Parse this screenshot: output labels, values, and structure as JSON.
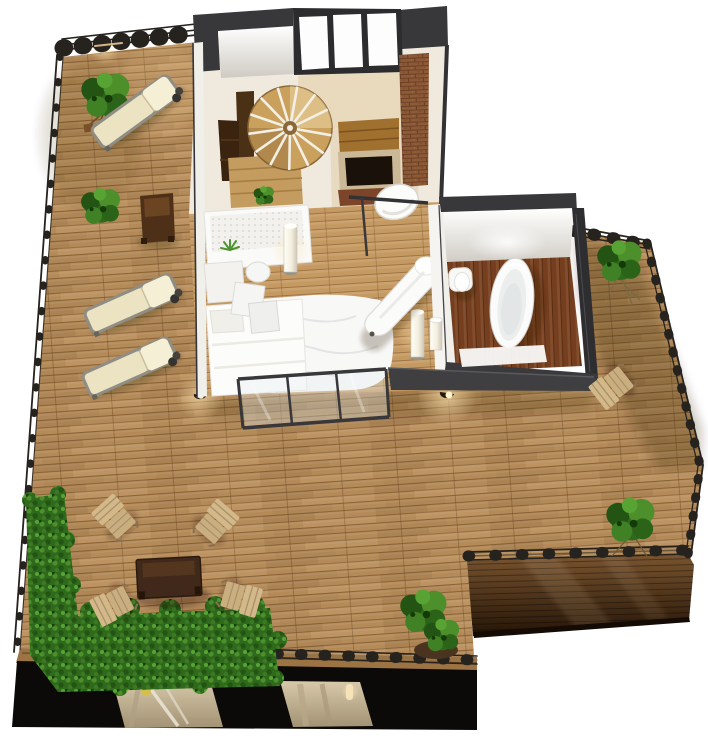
{
  "meta": {
    "title": "3D apartment floor plan with wrap-around wooden roof deck",
    "view": "top-down isometric architectural rendering",
    "background": "#ffffff"
  },
  "colors": {
    "background": "#ffffff",
    "deck_wood": "#b48a58",
    "deck_plank_line": "#8a6336",
    "deck_wood_light": "#c79a62",
    "deck_fascia": "#9c7444",
    "deck_side_top": "#7a5530",
    "deck_side_dark": "#241406",
    "bedroom_floor": "#c59a62",
    "bedroom_plank_line": "#9f7442",
    "bathroom_floor": "#753f1f",
    "bathroom_plank_line": "#572d14",
    "living_floor": "#efe9de",
    "wall_dark": "#38373a",
    "wall_white": "#f1efe9",
    "parapet": "#3f3e41",
    "brick": "#8d5a38",
    "brick_mortar": "#6b3f24",
    "facade_black": "#0c0a08",
    "facade_window": "#c9b99c",
    "soil": "#4a3420",
    "foliage": "#2f6a1c",
    "foliage_light": "#4c8f2b",
    "foliage_dark": "#245414",
    "railing": "#26221e",
    "cushion_cream": "#ece3c2",
    "cushion_back": "#f5efd6",
    "chair_wood": "#d3b88a",
    "table_wood": "#40291a",
    "bench_wood": "#4e3018",
    "stair_wood": "#c9a05c",
    "fixture_white": "#fbfbfb",
    "glow_warm": "#ffe3ae",
    "lamp_yellow": "#d4bf4e"
  },
  "rooms": [
    {
      "id": "living-room",
      "label": "Living room",
      "features": [
        "spiral staircase",
        "kitchen counter",
        "brick fireplace",
        "white armchair",
        "windows on north wall"
      ]
    },
    {
      "id": "bedroom",
      "label": "Bedroom / lounge",
      "features": [
        "white bed",
        "fluffy white rug",
        "white chaise longue",
        "desk with pegboard and aloe plant",
        "two cylinder floor lamps",
        "two cube stools",
        "glass window wall to deck"
      ]
    },
    {
      "id": "hallway",
      "label": "Hallway",
      "features": [
        "pedestal sink"
      ]
    },
    {
      "id": "bathroom",
      "label": "Bathroom",
      "features": [
        "freestanding oval bathtub",
        "toilet",
        "white bath mat",
        "dark plank floor",
        "ceiling light"
      ]
    }
  ],
  "outdoor": {
    "areas": [
      {
        "id": "upper-terrace",
        "label": "Upper left terrace"
      },
      {
        "id": "main-roof-deck",
        "label": "Main roof deck"
      },
      {
        "id": "side-terrace",
        "label": "Right side terrace"
      }
    ],
    "furniture": [
      {
        "type": "sun lounger with wheels",
        "count": 3
      },
      {
        "type": "wooden folding chair",
        "count": 5
      },
      {
        "type": "dark coffee table",
        "count": 1
      },
      {
        "type": "dark side bench",
        "count": 1
      }
    ],
    "plants": [
      {
        "type": "hedge planter strip",
        "count": 2
      },
      {
        "type": "shrub",
        "count": 6
      }
    ],
    "lights": [
      {
        "type": "recessed deck ground light",
        "count": 3
      }
    ],
    "railings": "thin dark metal railings along all open deck edges"
  },
  "lower_level": {
    "description": "black facade of the storey below",
    "windows": 2,
    "window_contents": [
      "lit interior with ladder shapes and yellow globe",
      "lit interior with wall lamp"
    ]
  }
}
